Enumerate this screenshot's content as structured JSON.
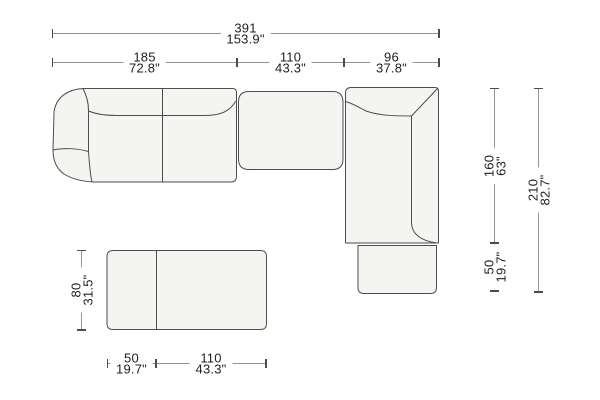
{
  "diagram_title": "sectional-sofa-plan-with-dimensions",
  "colors": {
    "background": "#ffffff",
    "sofa_fill": "#f4f4f2",
    "sofa_outline": "#4d4d4d",
    "dimension_line": "#949494",
    "dimension_tick": "#4c4c4c",
    "text": "#1f1f1f"
  },
  "dims": {
    "total_width": {
      "cm": "391",
      "inch": "153.9\""
    },
    "left_section_width": {
      "cm": "185",
      "inch": "72.8\""
    },
    "middle_section_width": {
      "cm": "110",
      "inch": "43.3\""
    },
    "right_section_width": {
      "cm": "96",
      "inch": "37.8\""
    },
    "chaise_depth": {
      "cm": "160",
      "inch": "63\""
    },
    "chaise_ottoman_depth": {
      "cm": "50",
      "inch": "19.7\""
    },
    "total_depth": {
      "cm": "210",
      "inch": "82.7\""
    },
    "bench_depth": {
      "cm": "80",
      "inch": "31.5\""
    },
    "bench_left_width": {
      "cm": "50",
      "inch": "19.7\""
    },
    "bench_right_width": {
      "cm": "110",
      "inch": "43.3\""
    }
  }
}
